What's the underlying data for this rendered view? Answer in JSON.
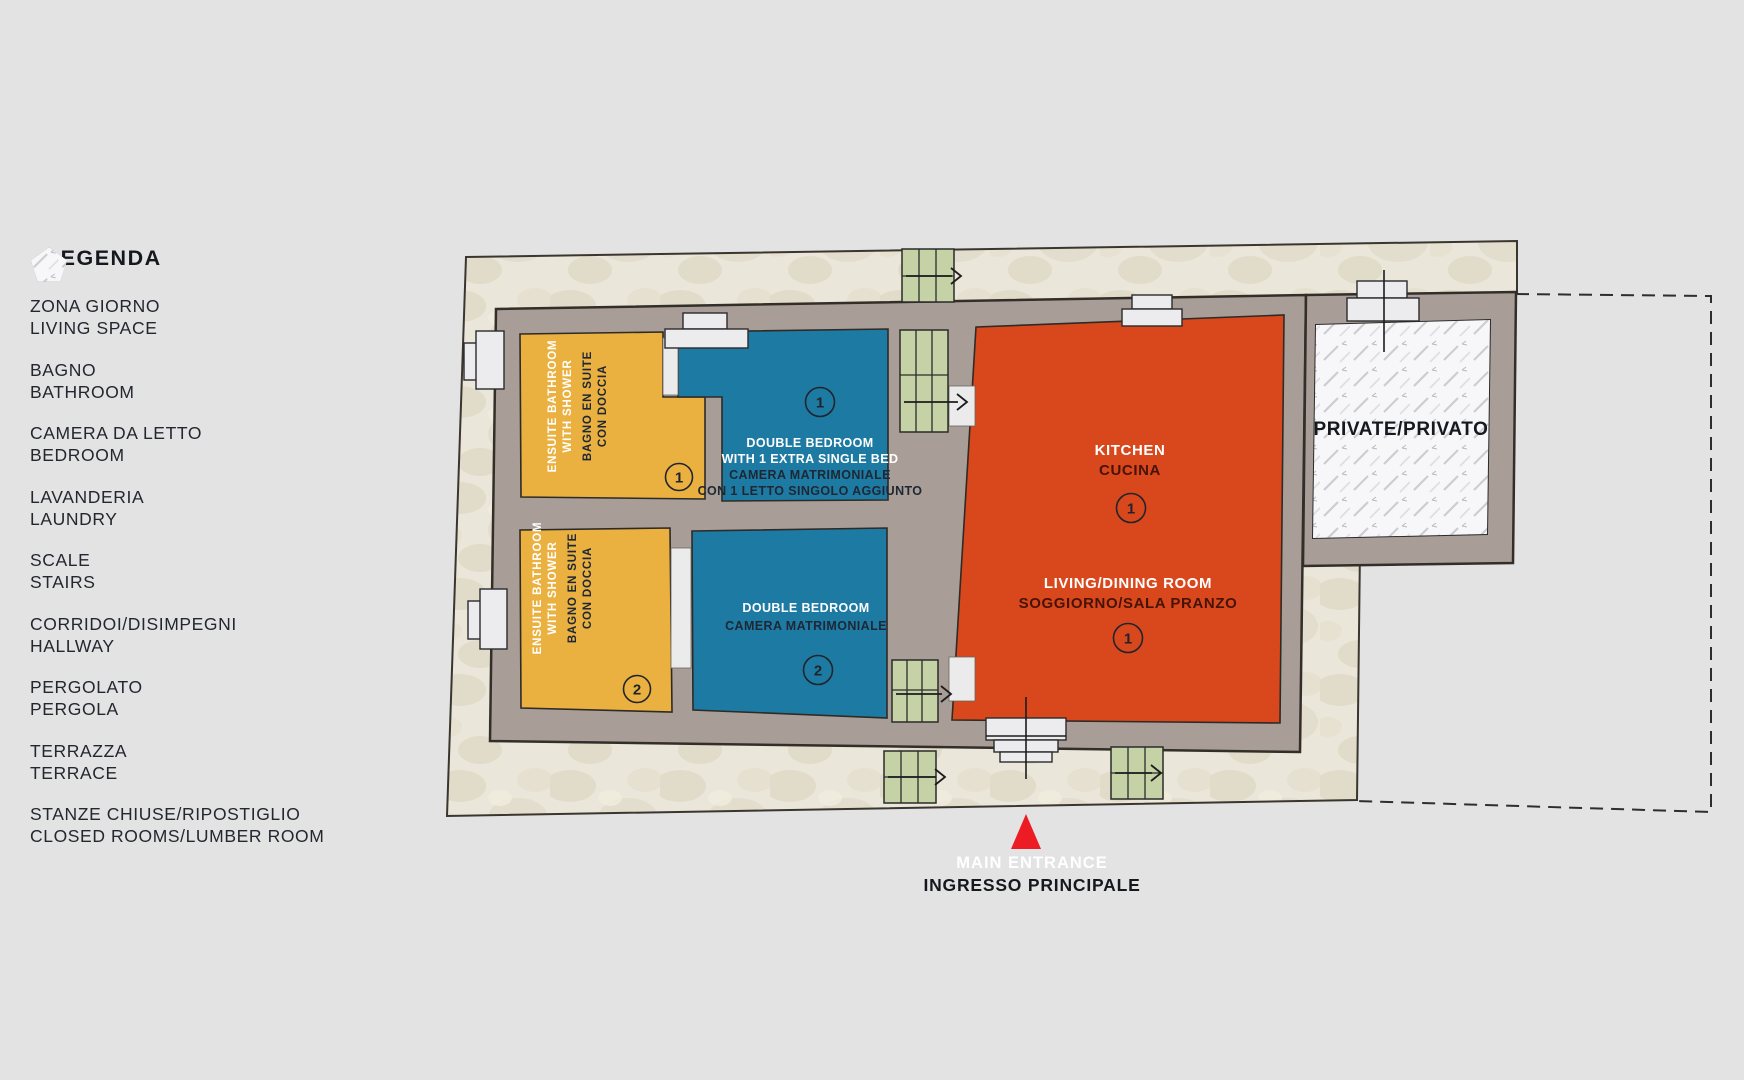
{
  "legend": {
    "title": "LEGENDA",
    "items": [
      {
        "name": "living-space",
        "it": "ZONA GIORNO",
        "en": "LIVING SPACE",
        "color": "#d9481c"
      },
      {
        "name": "bathroom",
        "it": "BAGNO",
        "en": "BATHROOM",
        "color": "#eab140"
      },
      {
        "name": "bedroom",
        "it": "CAMERA DA LETTO",
        "en": "BEDROOM",
        "color": "#1d7ba3"
      },
      {
        "name": "laundry",
        "it": "LAVANDERIA",
        "en": "LAUNDRY",
        "color": "#a6a5ee"
      },
      {
        "name": "stairs",
        "it": "SCALE",
        "en": "STAIRS",
        "color": "#c5d2a5"
      },
      {
        "name": "hallway",
        "it": "CORRIDOI/DISIMPEGNI",
        "en": "HALLWAY",
        "color": "#a8b2a4"
      },
      {
        "name": "pergola",
        "it": "PERGOLATO",
        "en": "PERGOLA",
        "color": "#558577"
      },
      {
        "name": "terrace",
        "it": "TERRAZZA",
        "en": "TERRACE",
        "color": "#8fcddb"
      },
      {
        "name": "closed-rooms",
        "it": "STANZE CHIUSE/RIPOSTIGLIO",
        "en": "CLOSED ROOMS/LUMBER ROOM",
        "color": "#f6f6f8"
      }
    ]
  },
  "plan": {
    "rooms": {
      "bathroom1": {
        "l1": "ENSUITE BATHROOM",
        "l2": "WITH SHOWER",
        "l3": "BAGNO EN SUITE",
        "l4": "CON DOCCIA",
        "number": "1"
      },
      "bathroom2": {
        "l1": "ENSUITE BATHROOM",
        "l2": "WITH SHOWER",
        "l3": "BAGNO EN SUITE",
        "l4": "CON DOCCIA",
        "number": "2"
      },
      "bedroom1": {
        "l1": "DOUBLE BEDROOM",
        "l2": "WITH 1 EXTRA SINGLE BED",
        "l3": "CAMERA MATRIMONIALE",
        "l4": "CON 1 LETTO SINGOLO AGGIUNTO",
        "number": "1"
      },
      "bedroom2": {
        "l1": "DOUBLE BEDROOM",
        "l2": "CAMERA MATRIMONIALE",
        "number": "2"
      },
      "kitchen": {
        "l1": "KITCHEN",
        "l2": "CUCINA",
        "number": "1"
      },
      "living": {
        "l1": "LIVING/DINING ROOM",
        "l2": "SOGGIORNO/SALA PRANZO",
        "number": "1"
      },
      "private": {
        "label": "PRIVATE/PRIVATO"
      }
    },
    "entrance": {
      "l1": "MAIN ENTRANCE",
      "l2": "INGRESSO PRINCIPALE"
    }
  },
  "colors": {
    "background": "#e3e3e4",
    "terrace_ground": "#eae6d9",
    "wall": "#a89e97",
    "living": "#d9481c",
    "bathroom": "#eab140",
    "bedroom": "#1d7ba3",
    "stairs": "#c5d2a5",
    "entrance": "#ed1c24"
  }
}
